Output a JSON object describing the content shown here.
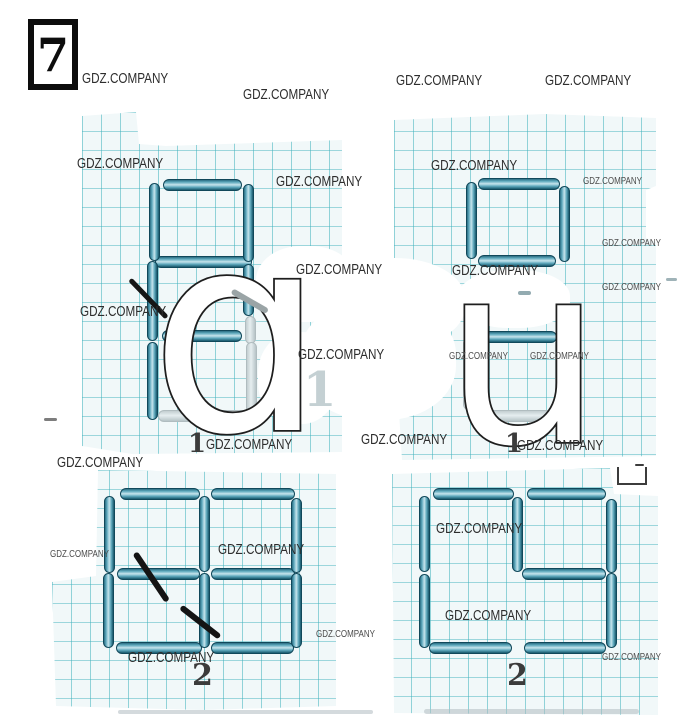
{
  "page": {
    "problem_number": "7",
    "watermark": "GDZ.COMPANY",
    "overlay_letters": {
      "left": "ɑ",
      "right": "u"
    },
    "figure_labels": {
      "figure1_left": "1",
      "figure1_right": "1",
      "figure2_left": "2",
      "figure2_right": "2"
    },
    "faint_pencil_digit": "1",
    "colors": {
      "matchstick_teal": "#2f7e95",
      "grid_line": "#48b2bd",
      "watermark_text": "#2d2d2d",
      "pen_mark": "#161616",
      "paper": "#f1f8f9"
    }
  }
}
